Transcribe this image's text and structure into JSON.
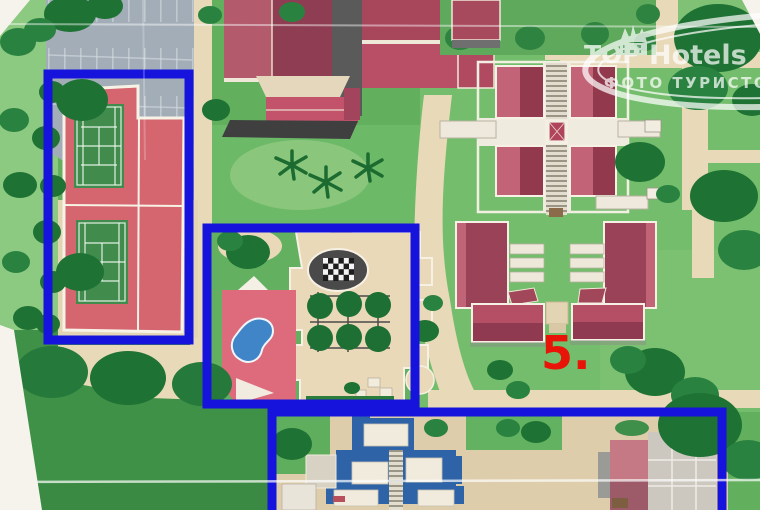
{
  "map": {
    "label_5": "5.",
    "colors": {
      "highlight": "#1513dc",
      "label": "#e81408",
      "grass": "#62af5e",
      "path": "#e8d9b8",
      "roof": "#9a4258",
      "pool_water": "#3f85c7",
      "aquapark_water": "#2e63a8"
    }
  },
  "watermark": {
    "brand_top": "TOP",
    "brand_rest": "Hotels",
    "subtitle": "ФОТО ТУРИСТОВ"
  }
}
